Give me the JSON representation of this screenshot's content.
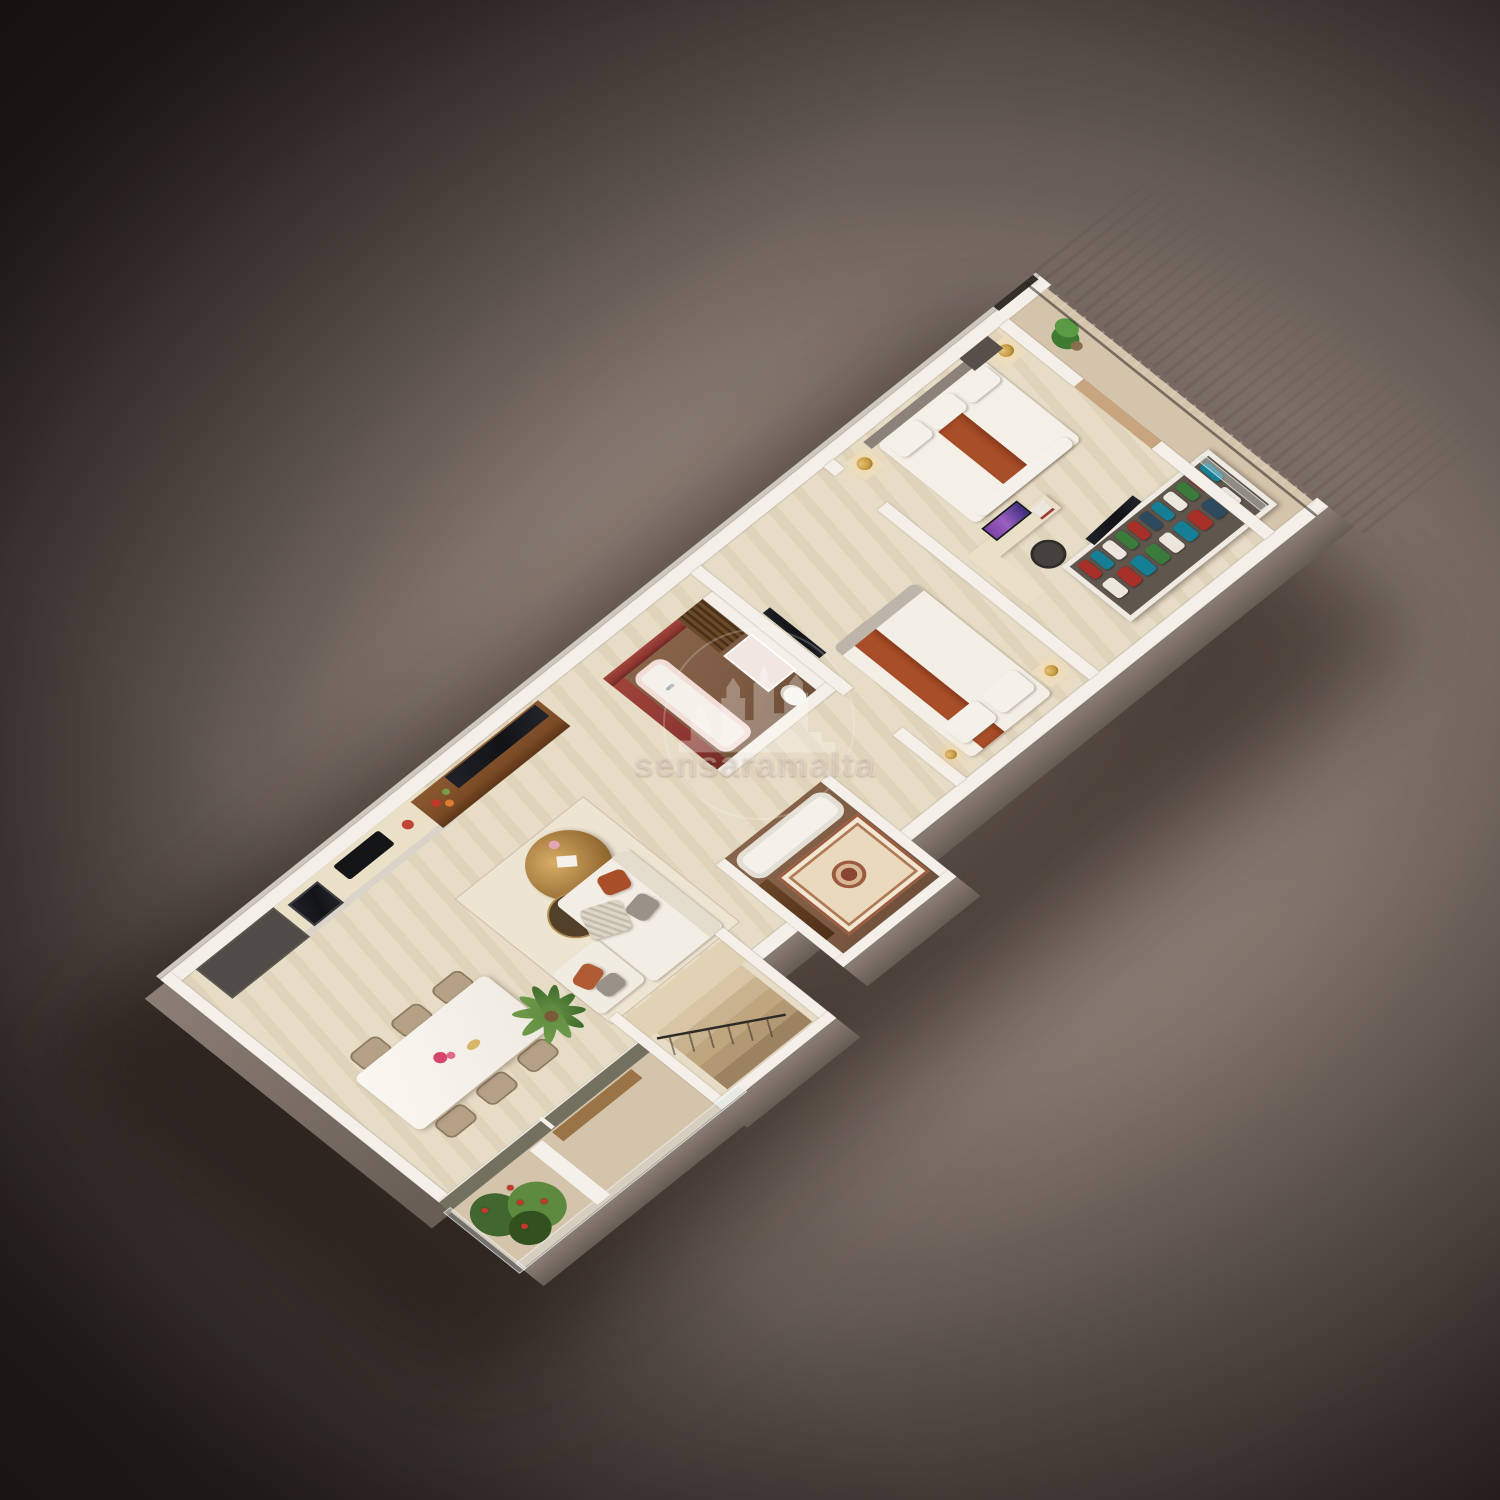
{
  "watermark": {
    "text": "sensaramalta",
    "logo": "castle-skyline-badge"
  },
  "scene": {
    "type": "isometric-3d-floor-plan",
    "rooms": [
      "balcony-terrace",
      "kitchen",
      "dining-area",
      "living-room",
      "staircase",
      "guest-bathroom",
      "master-bathroom",
      "bedroom",
      "walk-in-closet",
      "master-bedroom",
      "master-balcony"
    ]
  },
  "palette": {
    "background_light": "#a2938a",
    "background_dark": "#2b2422",
    "floor": "#e7dcc6",
    "balcony_floor": "#d5c4ac",
    "wall_white": "#f4f0e9",
    "wall_exterior": "#8b7e75",
    "accent_rust": "#a84e28",
    "bathroom_red": "#8e3732",
    "wood_walnut": "#7b4b26",
    "floor_bath_brown": "#7d5a42",
    "gold": "#c79a3f",
    "tv_black": "#121316",
    "screen_purple": "#9a5ec0",
    "plant_green": "#5d8a3f",
    "railing_dark": "#342f2b",
    "sofa_white": "#f3eee5",
    "pillow_gray": "#9a9189",
    "mosaic_rug": "#ead9bd",
    "flower_pink": "#d6456a",
    "flower_red": "#c0392b"
  }
}
